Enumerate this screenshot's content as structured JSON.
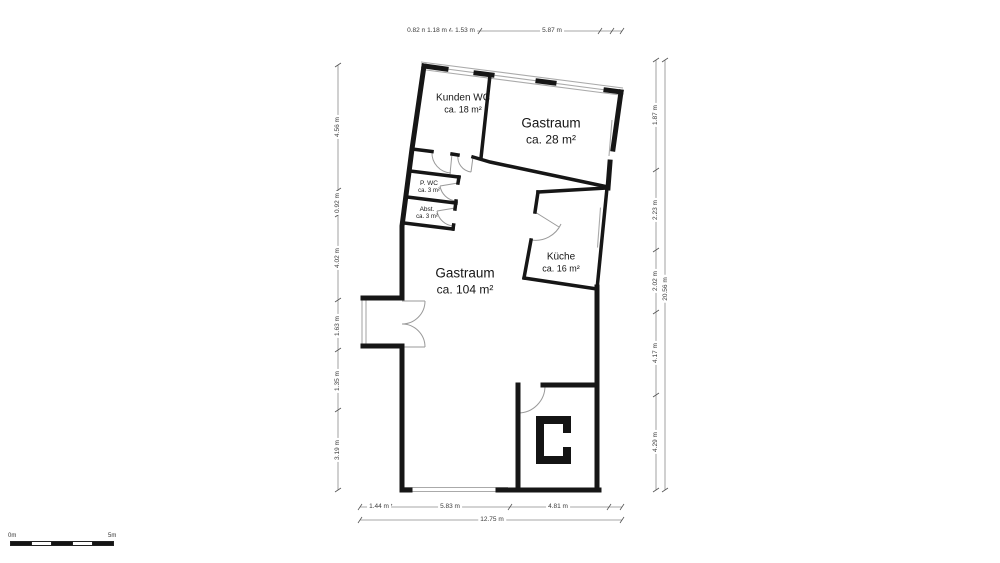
{
  "rooms": [
    {
      "name": "Kunden WC",
      "area": "ca. 18 m²"
    },
    {
      "name": "Gastraum",
      "area": "ca. 28 m²"
    },
    {
      "name": "P. WC",
      "area": "ca. 3 m²"
    },
    {
      "name": "Abst.",
      "area": "ca. 3 m²"
    },
    {
      "name": "Gastraum",
      "area": "ca. 104 m²"
    },
    {
      "name": "Küche",
      "area": "ca. 16 m²"
    }
  ],
  "dimensions": {
    "top": [
      "0.82 m",
      "1.18 m",
      "1.53 m",
      "5.87 m"
    ],
    "left": [
      "4.56 m",
      "0.92 m",
      "4.02 m",
      "1.63 m",
      "1.35 m",
      "3.19 m"
    ],
    "right": [
      "1.87 m",
      "2.23 m",
      "2.02 m",
      "4.17 m",
      "4.29 m"
    ],
    "right_total": "20.56 m",
    "bottom": [
      "1.44 m",
      "5.83 m",
      "4.81 m"
    ],
    "bottom_total": "12.75 m"
  },
  "scale_bar": {
    "min": "0m",
    "max": "5m"
  },
  "colors": {
    "wall": "#161616",
    "dim_line": "#8a8a8a",
    "text": "#1c1c1c"
  }
}
